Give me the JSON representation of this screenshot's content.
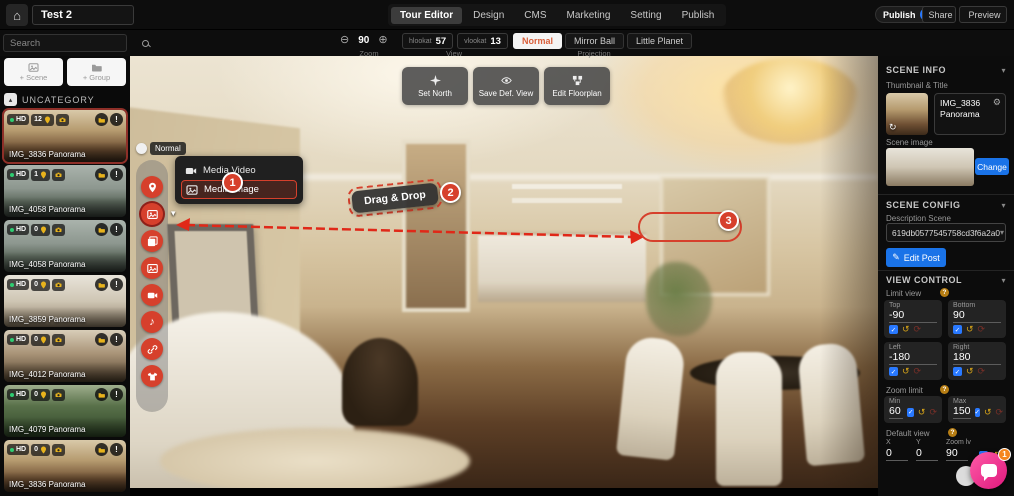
{
  "topbar": {
    "title_value": "Test 2",
    "tabs": [
      {
        "label": "Tour Editor"
      },
      {
        "label": "Design"
      },
      {
        "label": "CMS"
      },
      {
        "label": "Marketing"
      },
      {
        "label": "Setting"
      },
      {
        "label": "Publish"
      }
    ],
    "publish_label": "Publish",
    "share_label": "Share",
    "preview_label": "Preview"
  },
  "toolbar": {
    "search_placeholder": "Search",
    "zoom_value": "90",
    "zoom_label": "Zoom",
    "hlookat_label": "hlookat",
    "hlookat_value": "57",
    "vlookat_label": "vlookat",
    "vlookat_value": "13",
    "view_label": "View",
    "projection": {
      "normal": "Normal",
      "mirror": "Mirror Ball",
      "planet": "Little Planet",
      "label": "Projection"
    }
  },
  "scenes_panel": {
    "add_scene": "+ Scene",
    "add_group": "+ Group",
    "category": "UNCATEGORY",
    "scenes": [
      {
        "name": "IMG_3836 Panorama",
        "hd": "HD",
        "count": "12"
      },
      {
        "name": "IMG_4058 Panorama",
        "hd": "HD",
        "count": "1"
      },
      {
        "name": "IMG_4058 Panorama",
        "hd": "HD",
        "count": "0"
      },
      {
        "name": "IMG_3859 Panorama",
        "hd": "HD",
        "count": "0"
      },
      {
        "name": "IMG_4012 Panorama",
        "hd": "HD",
        "count": "0"
      },
      {
        "name": "IMG_4079 Panorama",
        "hd": "HD",
        "count": "0"
      },
      {
        "name": "IMG_3836 Panorama",
        "hd": "HD",
        "count": "0"
      }
    ]
  },
  "canvas": {
    "mode_label": "Normal",
    "set_north": "Set North",
    "save_view": "Save Def. View",
    "edit_floorplan": "Edit Floorplan",
    "media_video": "Media Video",
    "media_image": "Media Image",
    "drag_drop": "Drag & Drop",
    "step1": "1",
    "step2": "2",
    "step3": "3"
  },
  "inspector": {
    "tab_scene": "Scene",
    "tab_hotspot": "Hotspot",
    "hotspot_count": "12",
    "scene_info_title": "SCENE INFO",
    "thumbnail_title_label": "Thumbnail & Title",
    "scene_title_value": "IMG_3836 Panorama",
    "scene_image_label": "Scene image",
    "change_label": "Change",
    "scene_config_title": "SCENE CONFIG",
    "description_label": "Description Scene",
    "description_value": "619db0577545758cd3f6a2a0",
    "edit_post_label": "Edit Post",
    "view_control_title": "VIEW CONTROL",
    "limit_view_label": "Limit view",
    "limit_fields": [
      {
        "label": "Top",
        "value": "-90"
      },
      {
        "label": "Bottom",
        "value": "90"
      },
      {
        "label": "Left",
        "value": "-180"
      },
      {
        "label": "Right",
        "value": "180"
      }
    ],
    "zoom_limit_label": "Zoom limit",
    "zoom_fields": [
      {
        "label": "Min",
        "value": "60"
      },
      {
        "label": "Max",
        "value": "150"
      }
    ],
    "default_view_label": "Default view",
    "default_fields": [
      {
        "label": "X",
        "value": "0"
      },
      {
        "label": "Y",
        "value": "0"
      },
      {
        "label": "Zoom lv",
        "value": "90"
      }
    ]
  },
  "chat": {
    "badge": "1"
  },
  "icons": {
    "home": "⌂",
    "zoom_out": "⊖",
    "zoom_in": "⊕",
    "chevron_down": "▾",
    "chevron_up": "▴",
    "gear": "⚙",
    "refresh": "↻",
    "check": "✓",
    "undo": "↺",
    "redo": "⟳",
    "music": "♪",
    "pencil": "✎",
    "alert": "!",
    "help": "?"
  },
  "colors": {
    "accent_red": "#d6402c",
    "accent_blue": "#1a73e8",
    "toggle_blue": "#2979ff",
    "chat_pink": "#e0187c",
    "badge_orange": "#f5861f",
    "hd_green": "#2ecc71",
    "icon_yellow": "#e8b31c"
  }
}
